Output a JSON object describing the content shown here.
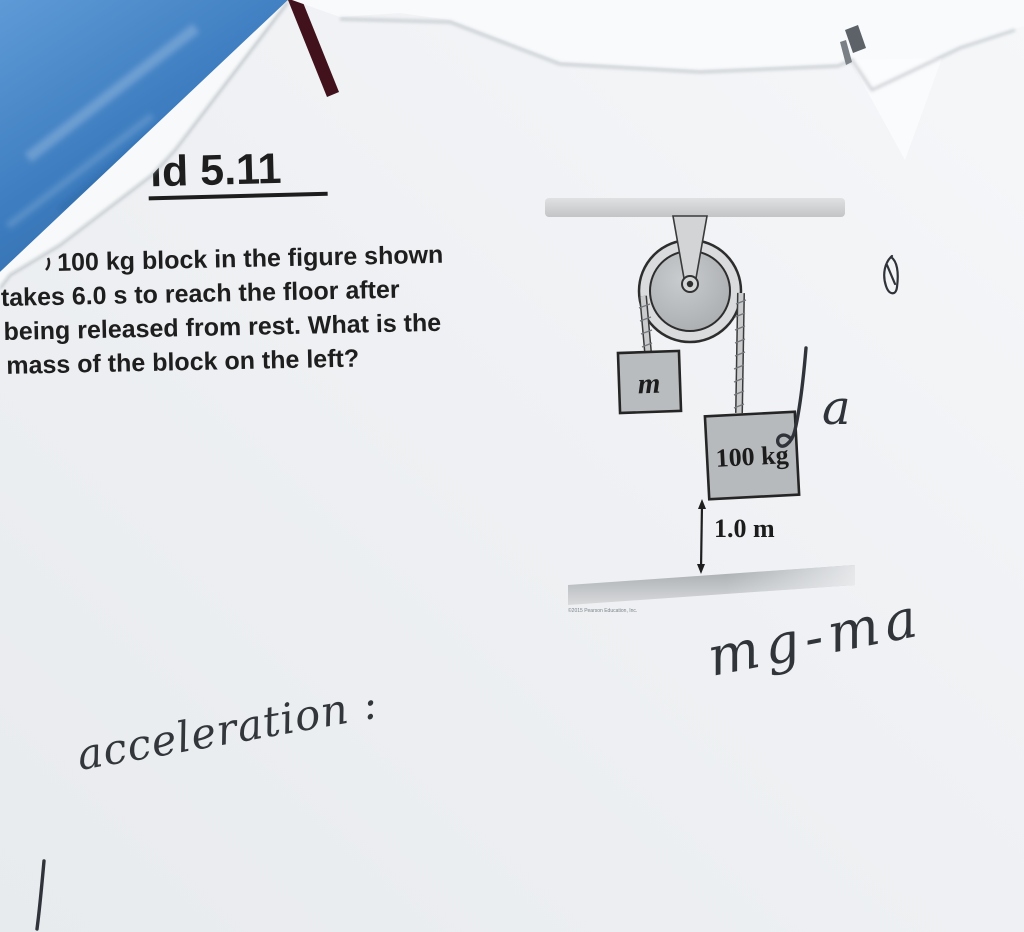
{
  "document": {
    "title": "id 5.11",
    "problem_lines": [
      "100 kg block in the figure shown",
      "takes 6.0 s to reach the floor after",
      "being released from rest. What is the",
      "mass of the block on the left?"
    ]
  },
  "figure": {
    "left_block_label": "m",
    "right_block_label": "100 kg",
    "height_label": "1.0 m",
    "micro_credit": "©2015 Pearson Education, Inc."
  },
  "handwriting": {
    "acceleration_label": "a",
    "equation": "mg-ma",
    "note": "acceleration :"
  },
  "colors": {
    "desk_blue": "#3d7ec2",
    "book_edge_maroon": "#41121c",
    "paper": "#eef0f3",
    "paper_bright": "#f8fafc",
    "print_ink": "#1e1e1e",
    "figure_gray": "#b8bbbd",
    "pen_ink": "#32363b"
  }
}
